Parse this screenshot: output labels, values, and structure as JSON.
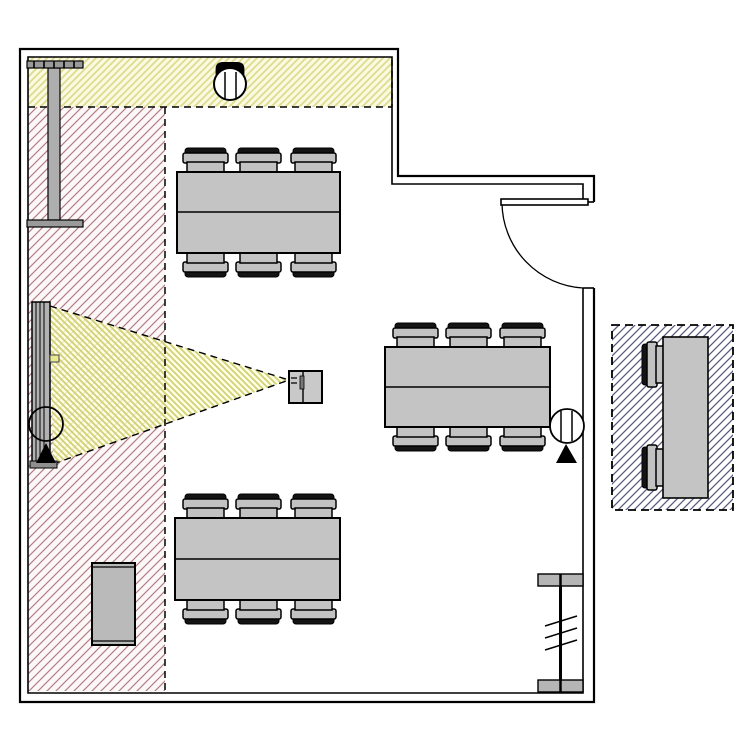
{
  "canvas": {
    "kind": "floor-plan-drawing",
    "width_px": 750,
    "height_px": 750,
    "background": "#ffffff"
  },
  "palette": {
    "wall_line": "#000000",
    "table_fill": "#c4c4c4",
    "table_stroke": "#000000",
    "chair_fill": "#c2c2c2",
    "chair_back_fill": "#141414",
    "cabinet_fill": "#bababa",
    "screen_fill": "#b2b2b2",
    "beam_post_fill": "#aeaeae",
    "beam_cap_fill": "#9a9a9a",
    "projector_fill": "#c9c9c9",
    "projector_lens_fill": "#787878",
    "device_fill": "#ffffff",
    "marker_fill": "#000000",
    "window_cap_fill": "#b5b5b5",
    "bracket_fill": "#e9e98f"
  },
  "zones": {
    "top_strip": {
      "name": "yellow-hatched-zone-top",
      "bg": "#fafae2",
      "line": "#dedc8e"
    },
    "left_area": {
      "name": "red-hatched-zone-left",
      "bg": "#fdf8f8",
      "line": "#b27e86"
    },
    "outside_right": {
      "name": "blue-hatched-zone-outside",
      "bg": "#ffffff",
      "line": "#5a5a7d"
    },
    "projection_beam": {
      "name": "projection-beam-cone",
      "bg": "rgba(255,255,224,0.78)",
      "line": "#d0d075"
    }
  },
  "objects": {
    "tables_in_room": 3,
    "chairs_per_table": 6,
    "outside_table_chairs": 2,
    "doors": 1,
    "ceiling_devices": 3,
    "components": [
      "room-walls",
      "door-with-swing",
      "meeting-table",
      "chair",
      "projection-screen",
      "projector",
      "ceiling-device",
      "sensor-marker",
      "wall-beam",
      "window-element",
      "cabinet",
      "outside-table"
    ]
  }
}
